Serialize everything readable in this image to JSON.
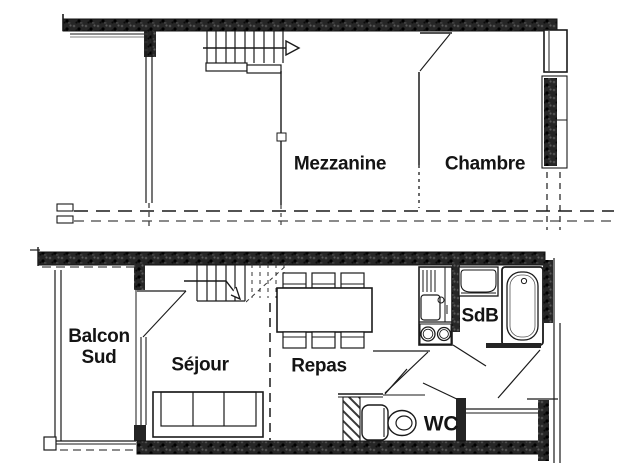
{
  "plan": {
    "upper_floor": {
      "rooms": [
        {
          "label": "Mezzanine"
        },
        {
          "label": "Chambre"
        }
      ],
      "fixtures": [
        "staircase-up-arrow",
        "bedroom-door-swing",
        "window",
        "facade-dashed-line"
      ]
    },
    "lower_floor": {
      "rooms": [
        {
          "label_line1": "Balcon",
          "label_line2": "Sud"
        },
        {
          "label": "Séjour"
        },
        {
          "label": "Repas"
        },
        {
          "label": "SdB"
        },
        {
          "label": "WC"
        }
      ],
      "fixtures": [
        "staircase-arrow",
        "balcony-door-swing",
        "sofa",
        "dining-table-six-chairs",
        "kitchenette-sink-drainboard",
        "stove-two-burners",
        "washbasin",
        "bathtub",
        "toilet",
        "door-swings",
        "entry-door-swing"
      ]
    }
  },
  "colors": {
    "ink": "#1a1a1a",
    "wall_fill": "#242424",
    "paper": "#ffffff"
  }
}
